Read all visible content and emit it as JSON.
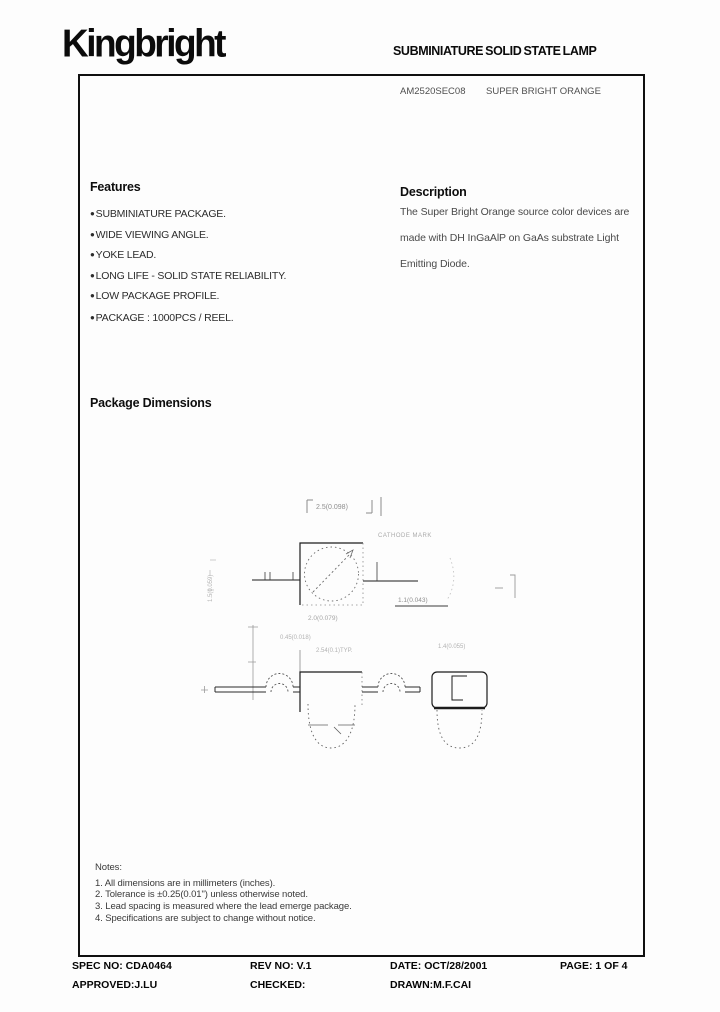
{
  "header": {
    "logo": "Kingbright",
    "doc_title": "SUBMINIATURE SOLID STATE LAMP"
  },
  "part": {
    "number": "AM2520SEC08",
    "color_name": "SUPER BRIGHT ORANGE"
  },
  "features": {
    "heading": "Features",
    "bullet": "●",
    "items": [
      "SUBMINIATURE PACKAGE.",
      "WIDE VIEWING ANGLE.",
      "YOKE LEAD.",
      "LONG LIFE - SOLID STATE RELIABILITY.",
      "LOW PACKAGE PROFILE.",
      "PACKAGE : 1000PCS / REEL."
    ]
  },
  "description": {
    "heading": "Description",
    "lines": [
      "The Super Bright Orange source color devices are",
      "made with DH InGaAlP on GaAs substrate Light",
      "Emitting Diode."
    ]
  },
  "package_dimensions": {
    "heading": "Package Dimensions",
    "labels": {
      "top_width": "2.5(0.098)",
      "depth": "2.0(0.079)",
      "lead": "1.1(0.043)",
      "cathode": "CATHODE MARK",
      "height_left": "1.5(0.059)",
      "pad": "0.45(0.018)",
      "pitch": "2.54(0.1)TYP.",
      "side_width": "1.4(0.055)"
    }
  },
  "notes": {
    "heading": "Notes:",
    "items": [
      "1. All dimensions are in millimeters (inches).",
      "2. Tolerance is ±0.25(0.01\") unless otherwise noted.",
      "3. Lead spacing is measured where the lead emerge package.",
      "4. Specifications are subject to change without notice."
    ]
  },
  "footer": {
    "spec_no": "SPEC NO: CDA0464",
    "rev_no": "REV NO: V.1",
    "date": "DATE: OCT/28/2001",
    "page": "PAGE: 1 OF 4",
    "approved": "APPROVED:J.LU",
    "checked": "CHECKED:",
    "drawn": "DRAWN:M.F.CAI"
  }
}
